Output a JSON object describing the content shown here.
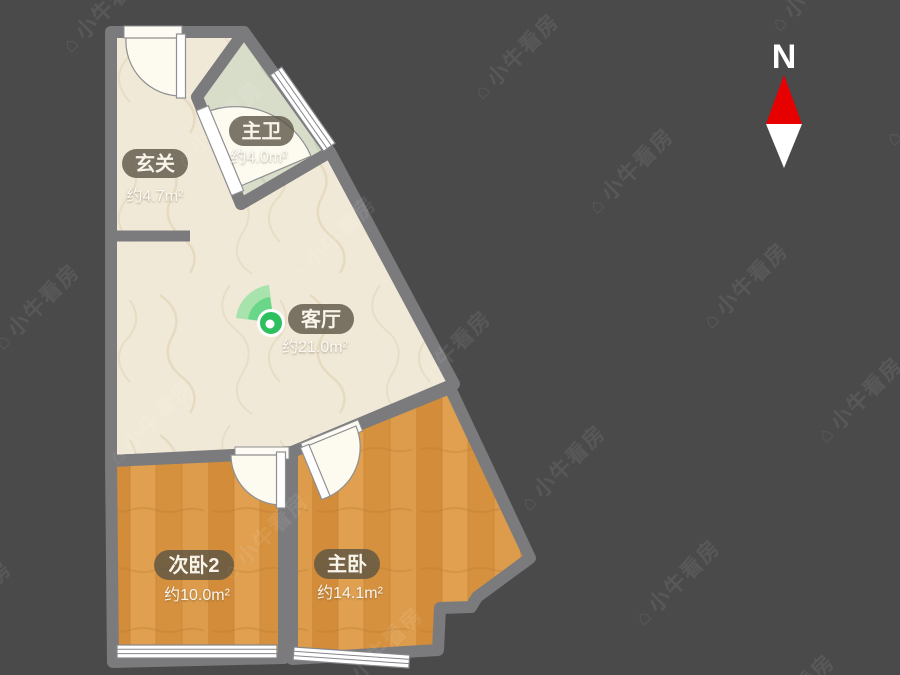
{
  "watermark": {
    "logo_icon": "house-icon",
    "text": "小牛看房"
  },
  "compass": {
    "label": "N"
  },
  "rooms": {
    "entry": {
      "name": "玄关",
      "area": "约4.7m²"
    },
    "bath": {
      "name": "主卫",
      "area": "约4.0m²"
    },
    "living": {
      "name": "客厅",
      "area": "约21.0m²"
    },
    "bedroom2": {
      "name": "次卧2",
      "area": "约10.0m²"
    },
    "master": {
      "name": "主卧",
      "area": "约14.1m²"
    }
  },
  "colors": {
    "background": "#4a4a4a",
    "wall": "#7b7b7d",
    "floor_beige": "#f1e9d7",
    "floor_bath": "#d8ddca",
    "floor_wood": "#d9953f",
    "label_bg": "rgba(88,82,68,0.78)",
    "accent_green": "#2ebf5e",
    "compass_red": "#e60000"
  }
}
